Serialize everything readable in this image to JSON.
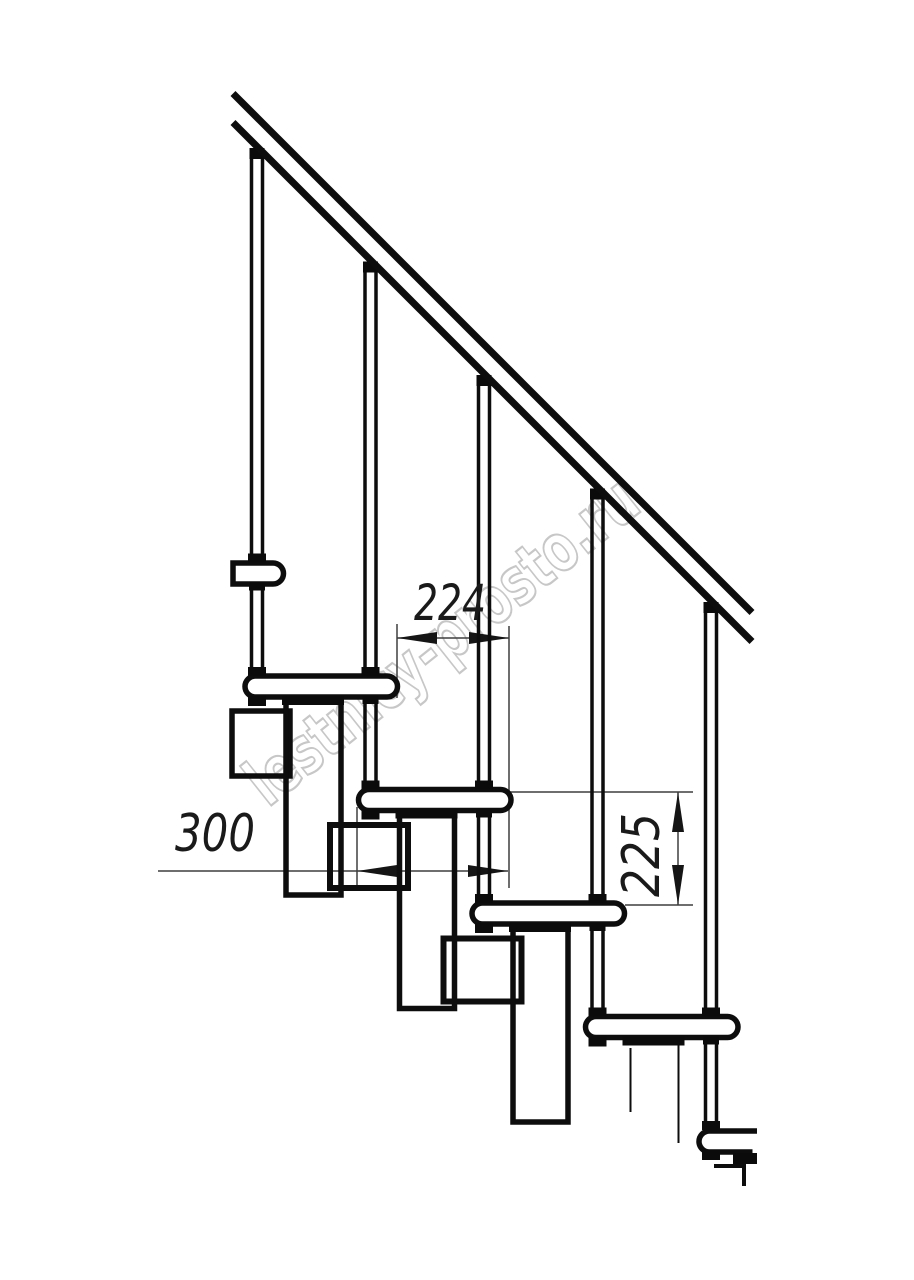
{
  "page": {
    "background": "#ffffff",
    "description": "Side elevation technical drawing of a modular staircase with handrail, balusters, treads and support modules"
  },
  "drawing": {
    "line_color": "#0d0d0d",
    "dim_line_color": "#3f3f3f",
    "dim_text_color": "#1a1a1a",
    "treads_visible": 6,
    "balusters_visible": 5
  },
  "dimensions": {
    "step_run": {
      "value": "224",
      "orientation": "horizontal"
    },
    "tread_depth": {
      "value": "300",
      "orientation": "horizontal"
    },
    "step_rise": {
      "value": "225",
      "orientation": "vertical"
    }
  },
  "watermark": {
    "text": "lestnicy-prosto.ru",
    "color": "#c7c7c7"
  }
}
